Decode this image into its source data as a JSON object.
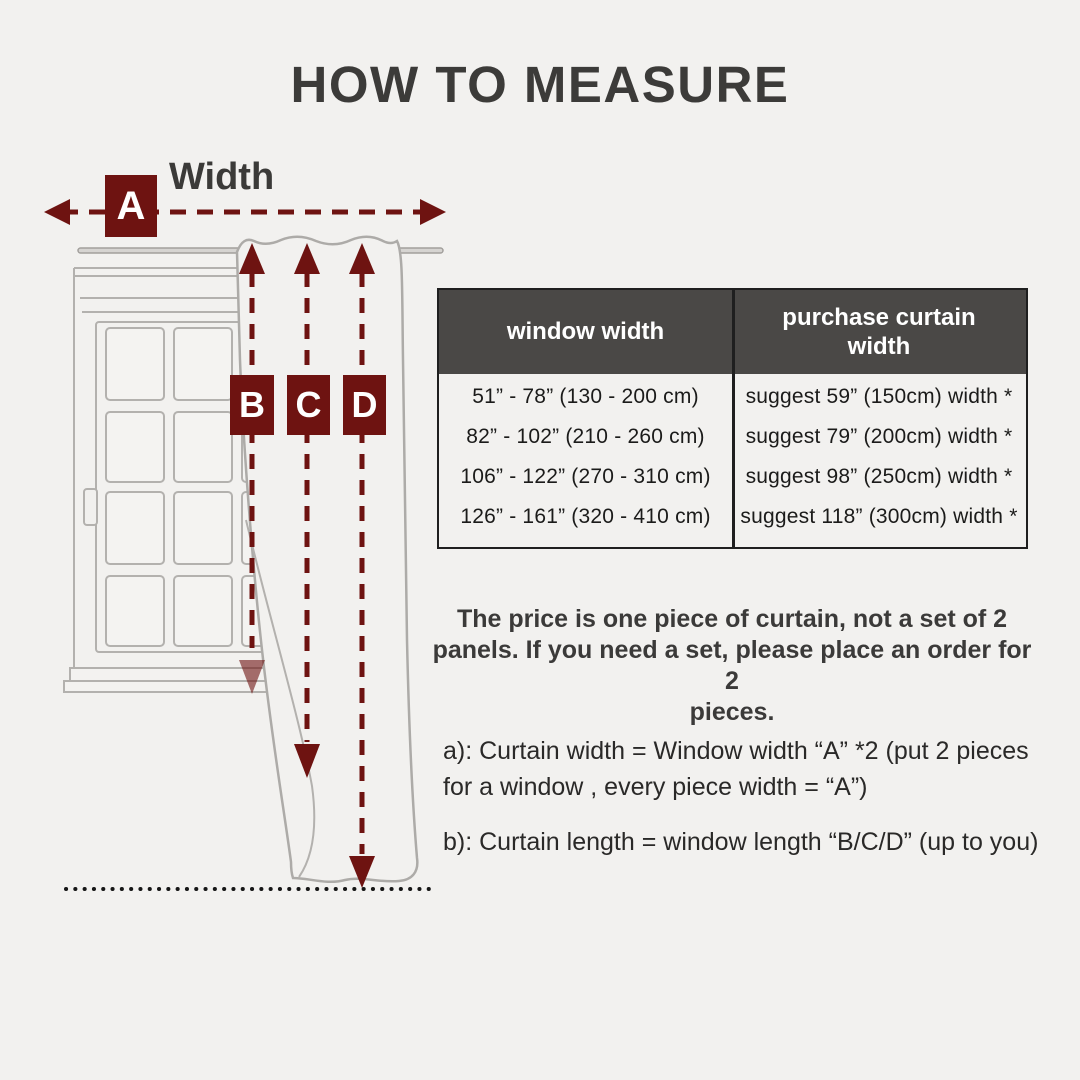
{
  "page": {
    "title": "HOW TO MEASURE",
    "background_color": "#f2f1ef",
    "accent_color": "#6e1311",
    "table_header_bg": "#4a4846",
    "table_border_color": "#1f1f1f",
    "text_color": "#3b3a39"
  },
  "diagram": {
    "width_label": "Width",
    "marker_a": "A",
    "marker_b": "B",
    "marker_c": "C",
    "marker_d": "D"
  },
  "size_table": {
    "headers": [
      "window width",
      "purchase curtain width"
    ],
    "rows": [
      [
        "51” - 78” (130 - 200 cm)",
        "suggest 59” (150cm) width *"
      ],
      [
        "82” - 102” (210 - 260 cm)",
        "suggest 79” (200cm) width *"
      ],
      [
        "106” - 122” (270 - 310 cm)",
        "suggest 98” (250cm) width *"
      ],
      [
        "126” - 161” (320 - 410 cm)",
        "suggest 118” (300cm) width *"
      ]
    ]
  },
  "notes": {
    "price_note_lines": [
      "The price is one piece of curtain, not a set of 2",
      "panels. If you need a set, please place an order for 2",
      "pieces."
    ],
    "note_a_lines": [
      "a): Curtain width = Window width “A” *2 (put 2 pieces",
      "for a window , every piece width = “A”)"
    ],
    "note_b": "b): Curtain length = window length “B/C/D” (up to you)"
  }
}
